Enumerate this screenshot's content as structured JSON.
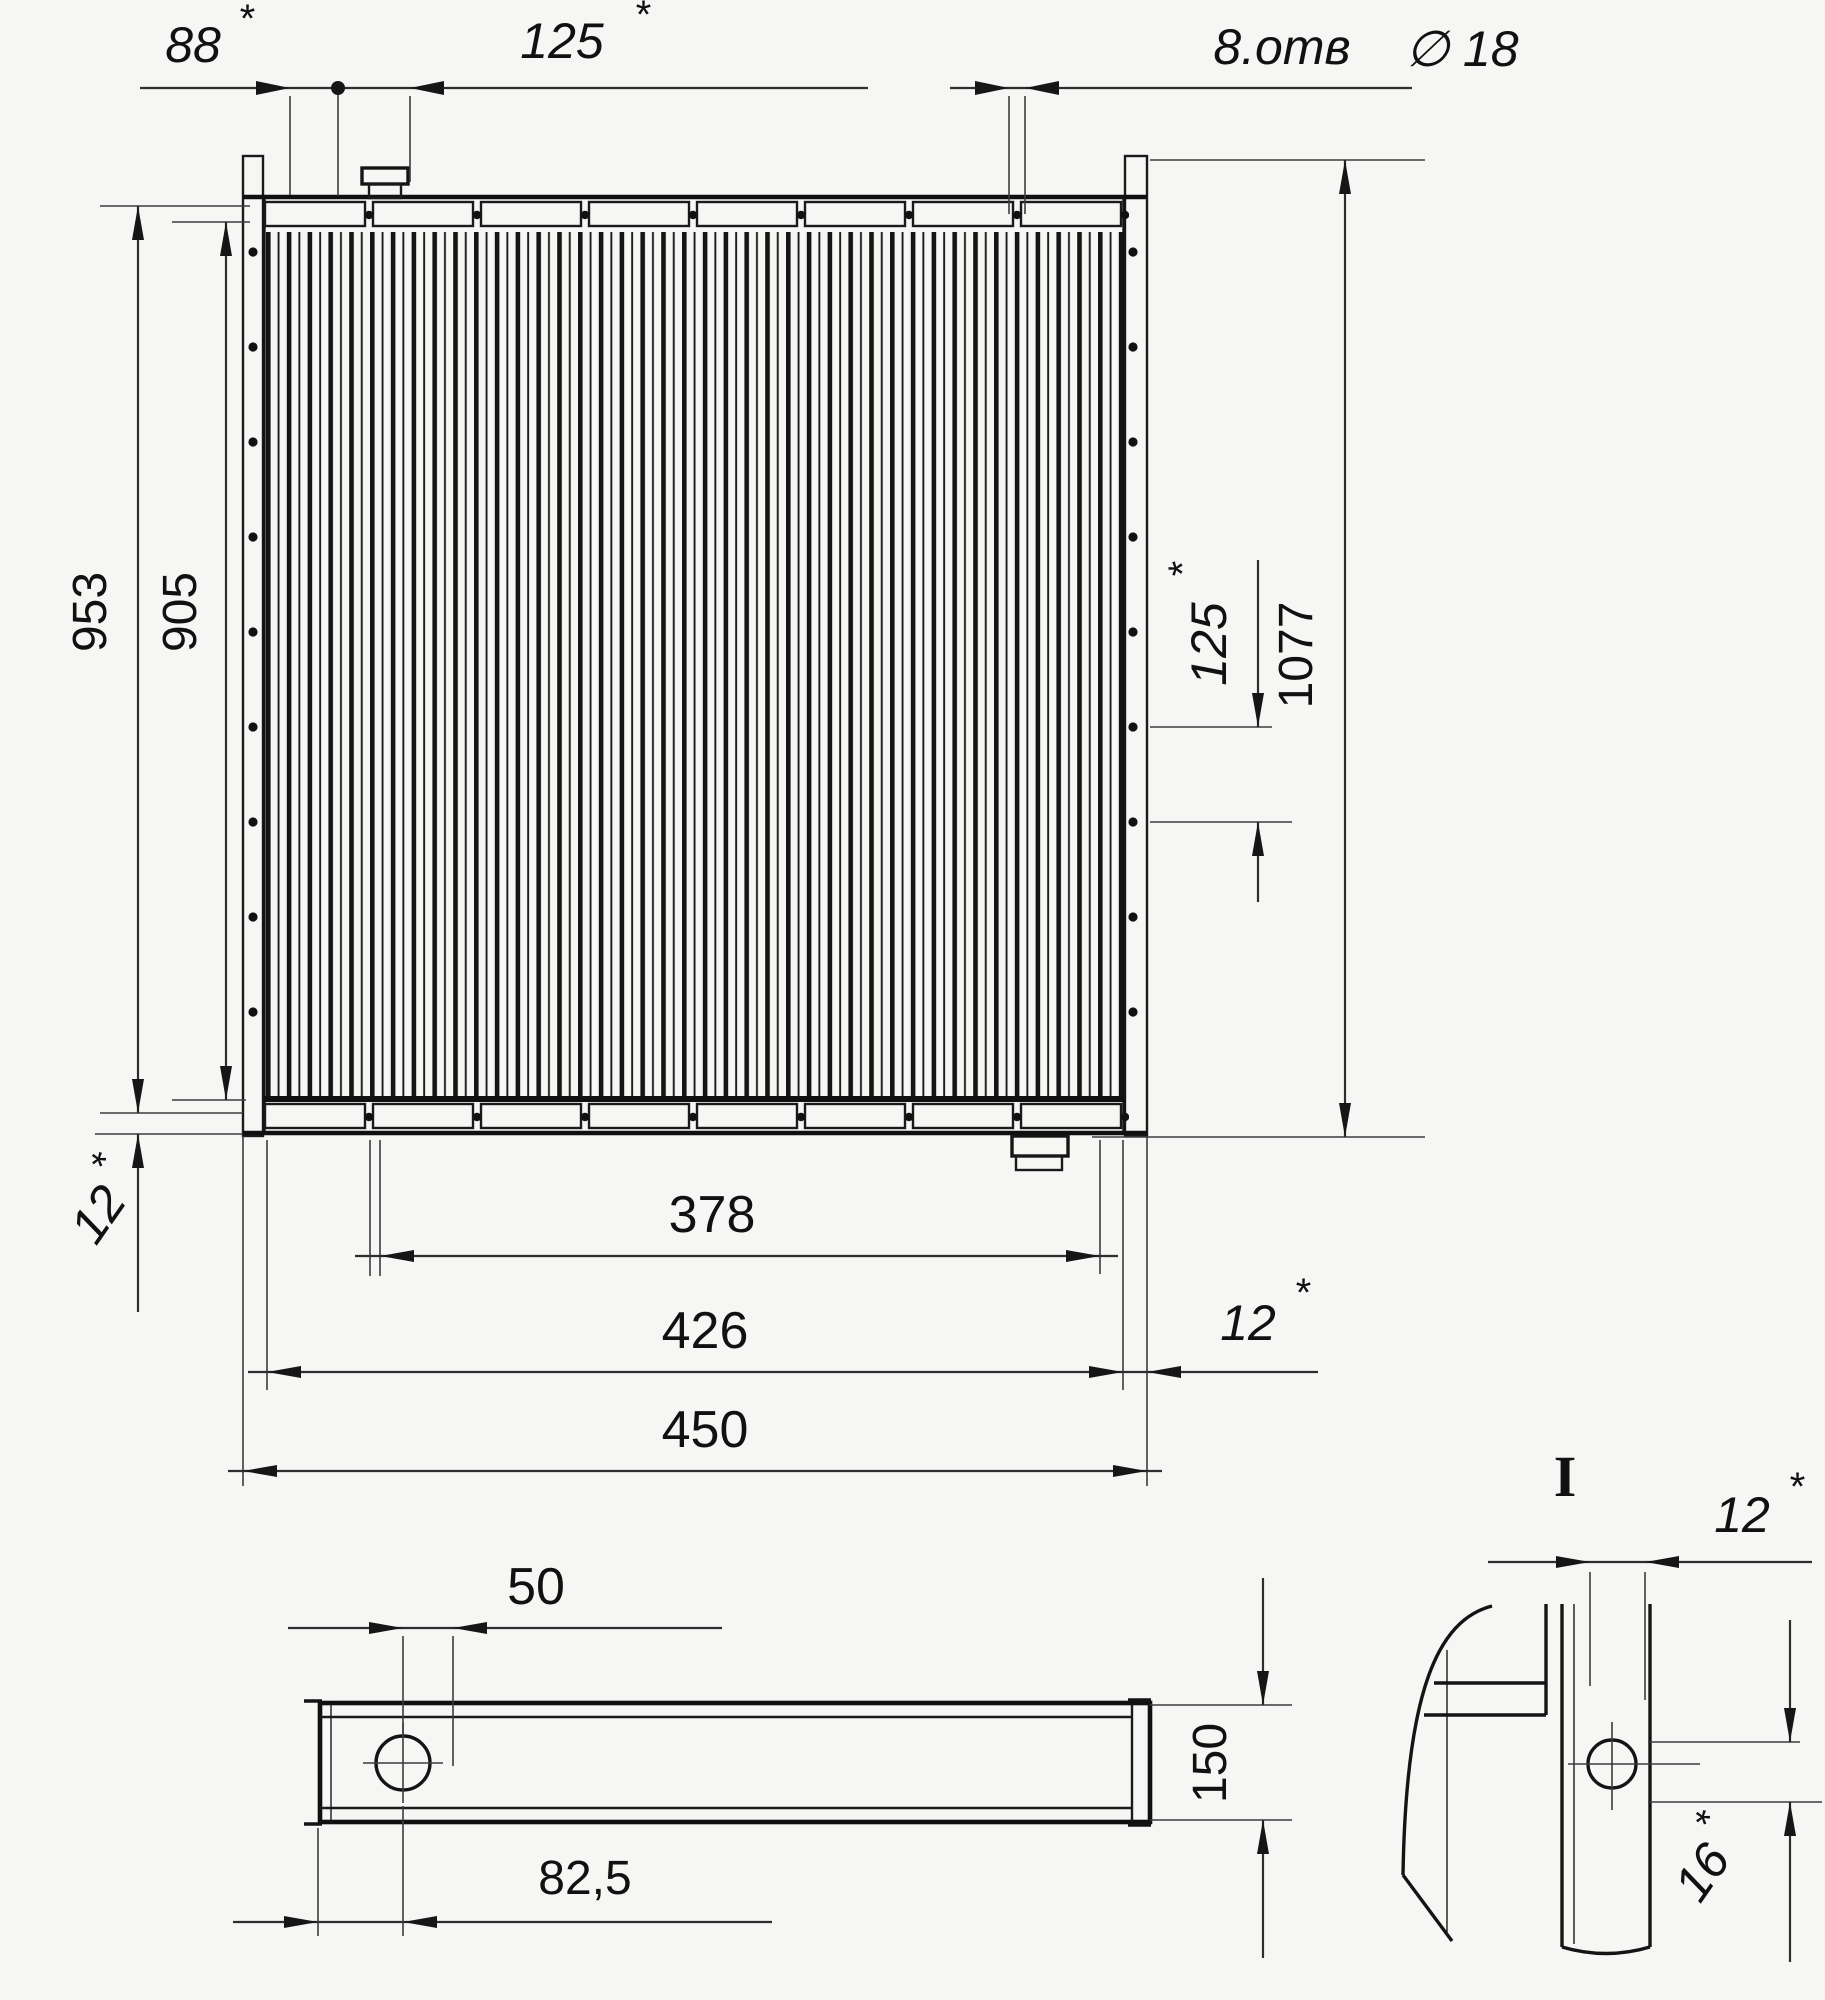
{
  "drawing": {
    "kind": "engineering-drawing",
    "subject": "radiator / heat-exchanger three-view dimensional drawing",
    "background": "#f6f6f4",
    "ink": "#161616"
  },
  "front_view": {
    "dims": {
      "offset_left": {
        "value": "88",
        "star": "*"
      },
      "pitch_top": {
        "value": "125",
        "star": "*"
      },
      "holes": {
        "count_label": "8.отв",
        "dia_label": "∅ 18"
      },
      "height_frame": {
        "value": "953"
      },
      "height_core": {
        "value": "905"
      },
      "height_overall": {
        "value": "1077"
      },
      "pitch_right": {
        "value": "125",
        "star": "*"
      },
      "edge_left": {
        "value": "12",
        "star": "*"
      },
      "width_core": {
        "value": "378"
      },
      "width_frame": {
        "value": "426"
      },
      "width_overall": {
        "value": "450"
      },
      "edge_right": {
        "value": "12",
        "star": "*"
      }
    }
  },
  "bottom_view": {
    "dims": {
      "pipe_width": {
        "value": "50"
      },
      "pipe_from_edge": {
        "value": "82,5"
      },
      "depth": {
        "value": "150"
      }
    }
  },
  "detail_view": {
    "label": "I",
    "dims": {
      "flange": {
        "value": "12",
        "star": "*"
      },
      "hole_offset": {
        "value": "16",
        "star": "*"
      }
    }
  }
}
